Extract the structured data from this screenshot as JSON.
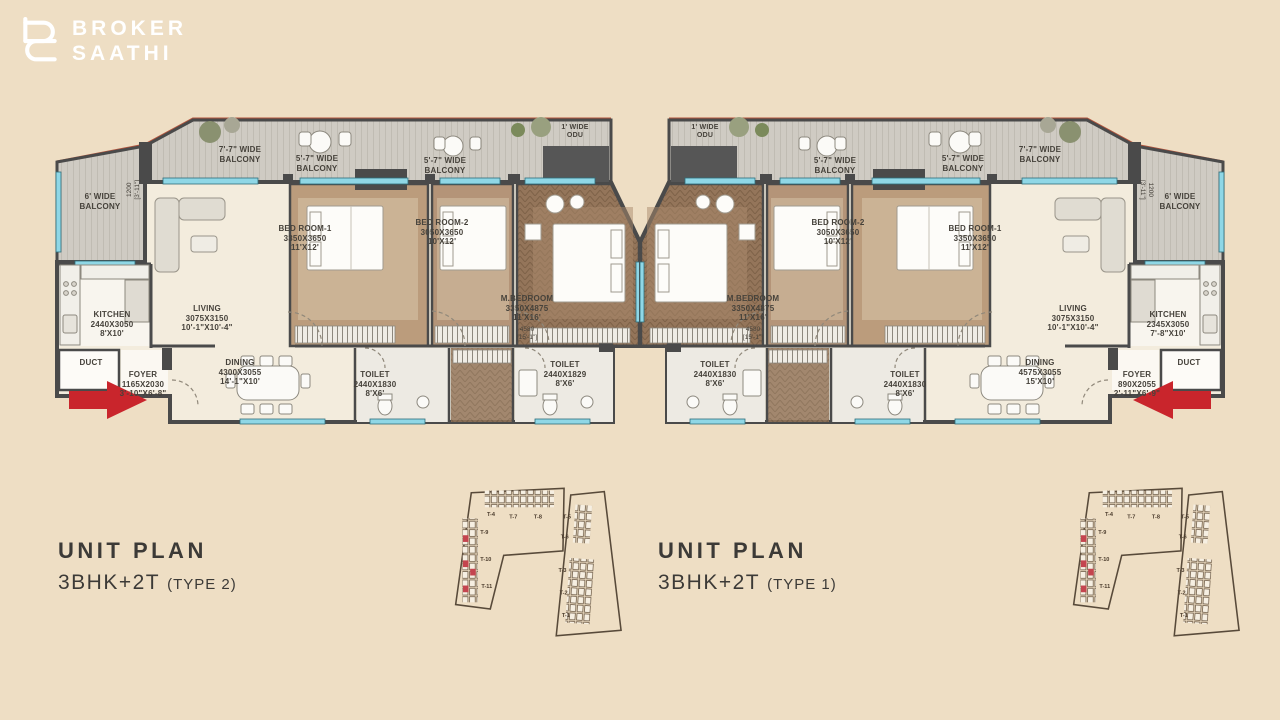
{
  "page": {
    "background": "#EEDEC4"
  },
  "brand": {
    "name_line1": "BROKER",
    "name_line2": "SAATHI"
  },
  "plans": [
    {
      "title": "UNIT PLAN",
      "config": "3BHK+2T",
      "type": "(TYPE 2)",
      "labels": {
        "balcony_77": "7'-7\" WIDE\nBALCONY",
        "balcony_57_a": "5'-7\" WIDE\nBALCONY",
        "balcony_57_b": "5'-7\" WIDE\nBALCONY",
        "odu": "1' WIDE\nODU",
        "balcony_6": "6' WIDE\nBALCONY",
        "balcony_6_dim": "1200\n[3'-11\"]",
        "kitchen": "KITCHEN\n2440X3050\n8'X10'",
        "living": "LIVING\n3075X3150\n10'-1\"X10'-4\"",
        "bedroom1": "BED ROOM-1\n3350X3650\n11'X12'",
        "bedroom2": "BED ROOM-2\n3050X3650\n10'X12'",
        "master_bedroom": "M.BEDROOM\n3350X4875\n11'X16'",
        "master_bedroom_dim": "4580\n[15'-1\"]",
        "duct": "DUCT",
        "foyer": "FOYER\n1165X2030\n3'-10\"X6'-8\"",
        "dining": "DINING\n4300X3055\n14'-1\"X10'",
        "toilet": "TOILET\n2440X1830\n8'X6'",
        "master_toilet": "TOILET\n2440X1829\n8'X6'"
      }
    },
    {
      "title": "UNIT PLAN",
      "config": "3BHK+2T",
      "type": "(TYPE 1)",
      "labels": {
        "balcony_77": "7'-7\" WIDE\nBALCONY",
        "balcony_57_a": "5'-7\" WIDE\nBALCONY",
        "balcony_57_b": "5'-7\" WIDE\nBALCONY",
        "odu": "1' WIDE\nODU",
        "balcony_6": "6' WIDE\nBALCONY",
        "balcony_6_dim": "1200\n[3'-11\"]",
        "kitchen": "KITCHEN\n2345X3050\n7'-8\"X10'",
        "living": "LIVING\n3075X3150\n10'-1\"X10'-4\"",
        "bedroom1": "BED ROOM-1\n3350X3650\n11'X12'",
        "bedroom2": "BED ROOM-2\n3050X3650\n10'X12'",
        "master_bedroom": "M.BEDROOM\n3350X4875\n11'X16'",
        "master_bedroom_dim": "4580\n[15'-1\"]",
        "duct": "DUCT",
        "foyer": "FOYER\n890X2055\n2'-11\"X6'-9\"",
        "dining": "DINING\n4575X3055\n15'X10'",
        "toilet": "TOILET\n2440X1830\n8'X6'",
        "master_toilet": "TOILET\n2440X1830\n8'X6'"
      }
    }
  ],
  "key_plan": {
    "tower_labels": [
      "T-4",
      "T-7",
      "T-8",
      "T-9",
      "T-10",
      "T-11",
      "T-5",
      "T-6",
      "T-3",
      "T-2",
      "T-1"
    ]
  },
  "colors": {
    "arrow_red": "#C9252C",
    "highlight_red": "#C4454F",
    "window_blue": "#8FD7E6",
    "wall_gray": "#4A4A4A",
    "parapet_red": "#B2543D"
  }
}
